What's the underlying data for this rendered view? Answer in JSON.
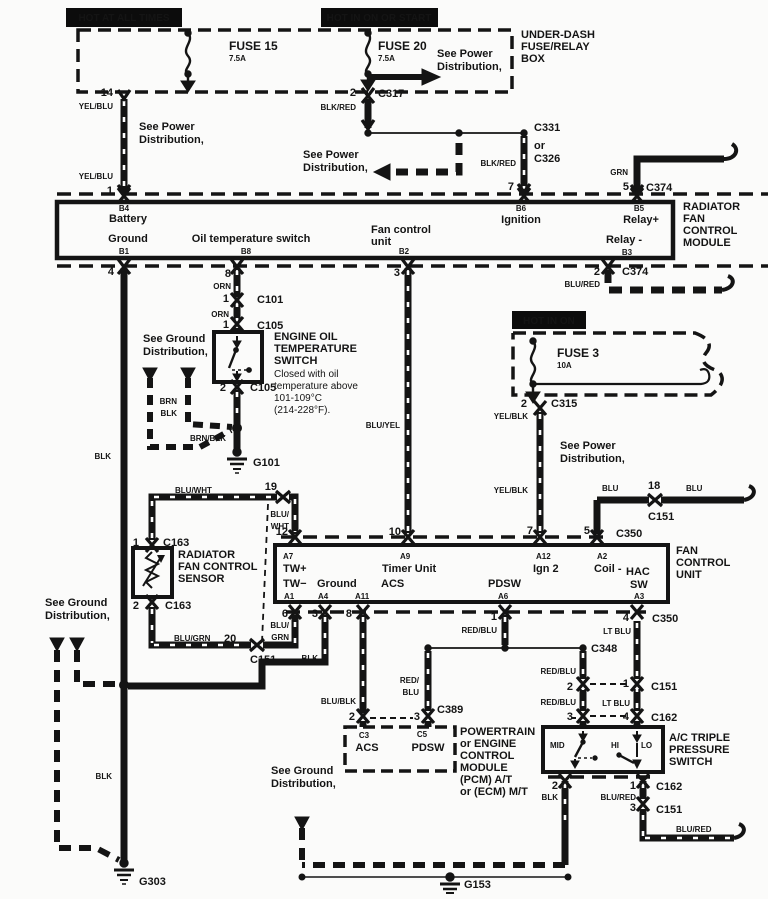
{
  "title": "Radiator fan control wiring diagram",
  "colors": {
    "ink": "#141414",
    "paper": "#fbfbfa",
    "inverse_text": "#ffffff"
  },
  "headers": {
    "hot_at_all_times": "HOT AT ALL TIMES",
    "hot_in_on_or_start": "HOT IN ON OR START",
    "hot_in_on": "HOT IN ON"
  },
  "labels": [
    {
      "n": "hot-at-all-times",
      "t": "HOT AT ALL TIMES",
      "x": 124,
      "y": 21,
      "a": "m",
      "s": 10,
      "c": "#ffffff"
    },
    {
      "n": "hot-in-on-or-start",
      "t": "HOT IN ON OR START",
      "x": 379,
      "y": 21,
      "a": "m",
      "s": 10,
      "c": "#ffffff"
    },
    {
      "n": "fuse15-name",
      "t": "FUSE 15",
      "x": 229,
      "y": 50,
      "s": 12
    },
    {
      "n": "fuse15-amp",
      "t": "7.5A",
      "x": 229,
      "y": 61,
      "s": 8
    },
    {
      "n": "fuse20-name",
      "t": "FUSE 20",
      "x": 378,
      "y": 50,
      "s": 12
    },
    {
      "n": "fuse20-amp",
      "t": "7.5A",
      "x": 378,
      "y": 61,
      "s": 8
    },
    {
      "n": "see-power-1a",
      "t": "See Power",
      "x": 437,
      "y": 57
    },
    {
      "n": "see-power-1b",
      "t": "Distribution,",
      "x": 437,
      "y": 70
    },
    {
      "n": "underdash-1",
      "t": "UNDER-DASH",
      "x": 521,
      "y": 38
    },
    {
      "n": "underdash-2",
      "t": "FUSE/RELAY",
      "x": 521,
      "y": 50
    },
    {
      "n": "underdash-3",
      "t": "BOX",
      "x": 521,
      "y": 62
    },
    {
      "n": "pin-14",
      "t": "14",
      "x": 113,
      "y": 96,
      "a": "e"
    },
    {
      "n": "wire-yelblu-1",
      "t": "YEL/BLU",
      "x": 113,
      "y": 109,
      "a": "e",
      "s": 8
    },
    {
      "n": "see-power-2a",
      "t": "See Power",
      "x": 139,
      "y": 130
    },
    {
      "n": "see-power-2b",
      "t": "Distribution,",
      "x": 139,
      "y": 143
    },
    {
      "n": "wire-yelblu-2",
      "t": "YEL/BLU",
      "x": 113,
      "y": 179,
      "a": "e",
      "s": 8
    },
    {
      "n": "pin-1",
      "t": "1",
      "x": 113,
      "y": 194,
      "a": "e"
    },
    {
      "n": "pin-2-c317",
      "t": "2",
      "x": 356,
      "y": 96,
      "a": "e"
    },
    {
      "n": "wire-blkred-1",
      "t": "BLK/RED",
      "x": 356,
      "y": 110,
      "a": "e",
      "s": 8
    },
    {
      "n": "conn-c317",
      "t": "C317",
      "x": 378,
      "y": 97
    },
    {
      "n": "conn-c331",
      "t": "C331",
      "x": 534,
      "y": 131
    },
    {
      "n": "conn-c326-or",
      "t": "or",
      "x": 534,
      "y": 149
    },
    {
      "n": "conn-c326",
      "t": "C326",
      "x": 534,
      "y": 162
    },
    {
      "n": "wire-blkred-2",
      "t": "BLK/RED",
      "x": 516,
      "y": 166,
      "a": "e",
      "s": 8
    },
    {
      "n": "see-power-3a",
      "t": "See Power",
      "x": 303,
      "y": 158
    },
    {
      "n": "see-power-3b",
      "t": "Distribution,",
      "x": 303,
      "y": 171
    },
    {
      "n": "wire-grn",
      "t": "GRN",
      "x": 628,
      "y": 175,
      "a": "e",
      "s": 8
    },
    {
      "n": "pin-7-c374",
      "t": "7",
      "x": 514,
      "y": 190,
      "a": "e"
    },
    {
      "n": "pin-5-c374",
      "t": "5",
      "x": 629,
      "y": 190,
      "a": "e"
    },
    {
      "n": "conn-c374-top",
      "t": "C374",
      "x": 646,
      "y": 191
    },
    {
      "n": "module-b4",
      "t": "B4",
      "x": 124,
      "y": 211,
      "a": "m",
      "s": 8
    },
    {
      "n": "module-battery",
      "t": "Battery",
      "x": 128,
      "y": 222,
      "a": "m"
    },
    {
      "n": "module-ground",
      "t": "Ground",
      "x": 128,
      "y": 242,
      "a": "m"
    },
    {
      "n": "module-b1",
      "t": "B1",
      "x": 124,
      "y": 254,
      "a": "m",
      "s": 8
    },
    {
      "n": "module-oil-temp",
      "t": "Oil temperature switch",
      "x": 251,
      "y": 242,
      "a": "m"
    },
    {
      "n": "module-b8",
      "t": "B8",
      "x": 246,
      "y": 254,
      "a": "m",
      "s": 8
    },
    {
      "n": "module-fan-a",
      "t": "Fan control",
      "x": 371,
      "y": 233
    },
    {
      "n": "module-fan-b",
      "t": "unit",
      "x": 371,
      "y": 245
    },
    {
      "n": "module-b2",
      "t": "B2",
      "x": 404,
      "y": 254,
      "a": "m",
      "s": 8
    },
    {
      "n": "module-b6",
      "t": "B6",
      "x": 521,
      "y": 211,
      "a": "m",
      "s": 8
    },
    {
      "n": "module-ignition",
      "t": "Ignition",
      "x": 521,
      "y": 223,
      "a": "m"
    },
    {
      "n": "module-b5",
      "t": "B5",
      "x": 639,
      "y": 211,
      "a": "m",
      "s": 8
    },
    {
      "n": "module-relay-plus",
      "t": "Relay+",
      "x": 641,
      "y": 223,
      "a": "m"
    },
    {
      "n": "module-relay-minus",
      "t": "Relay -",
      "x": 624,
      "y": 243,
      "a": "m"
    },
    {
      "n": "module-b3",
      "t": "B3",
      "x": 627,
      "y": 255,
      "a": "m",
      "s": 8
    },
    {
      "n": "rfcm-1",
      "t": "RADIATOR",
      "x": 683,
      "y": 210
    },
    {
      "n": "rfcm-2",
      "t": "FAN",
      "x": 683,
      "y": 222
    },
    {
      "n": "rfcm-3",
      "t": "CONTROL",
      "x": 683,
      "y": 234
    },
    {
      "n": "rfcm-4",
      "t": "MODULE",
      "x": 683,
      "y": 246
    },
    {
      "n": "pin-4",
      "t": "4",
      "x": 114,
      "y": 275,
      "a": "e"
    },
    {
      "n": "pin-8",
      "t": "8",
      "x": 231,
      "y": 277,
      "a": "e"
    },
    {
      "n": "wire-orn-1",
      "t": "ORN",
      "x": 231,
      "y": 289,
      "a": "e",
      "s": 8
    },
    {
      "n": "pin-3-b2",
      "t": "3",
      "x": 400,
      "y": 276,
      "a": "e"
    },
    {
      "n": "pin-2-c374",
      "t": "2",
      "x": 600,
      "y": 275,
      "a": "e"
    },
    {
      "n": "wire-blured-1",
      "t": "BLU/RED",
      "x": 600,
      "y": 287,
      "a": "e",
      "s": 8
    },
    {
      "n": "conn-c374-bot",
      "t": "C374",
      "x": 622,
      "y": 275
    },
    {
      "n": "pin-1-c101",
      "t": "1",
      "x": 229,
      "y": 302,
      "a": "e"
    },
    {
      "n": "conn-c101",
      "t": "C101",
      "x": 257,
      "y": 303
    },
    {
      "n": "wire-orn-2",
      "t": "ORN",
      "x": 229,
      "y": 317,
      "a": "e",
      "s": 8
    },
    {
      "n": "pin-1-c105",
      "t": "1",
      "x": 229,
      "y": 328,
      "a": "e"
    },
    {
      "n": "conn-c105-top",
      "t": "C105",
      "x": 257,
      "y": 329
    },
    {
      "n": "eots-1",
      "t": "ENGINE OIL",
      "x": 274,
      "y": 340
    },
    {
      "n": "eots-2",
      "t": "TEMPERATURE",
      "x": 274,
      "y": 352
    },
    {
      "n": "eots-3",
      "t": "SWITCH",
      "x": 274,
      "y": 364
    },
    {
      "n": "eots-note-1",
      "t": "Closed with oil",
      "x": 274,
      "y": 377,
      "w": 400,
      "s": 10
    },
    {
      "n": "eots-note-2",
      "t": "temperature above",
      "x": 274,
      "y": 389,
      "w": 400,
      "s": 10
    },
    {
      "n": "eots-note-3",
      "t": "101-109°C",
      "x": 274,
      "y": 401,
      "w": 400,
      "s": 10
    },
    {
      "n": "eots-note-4",
      "t": "(214-228°F).",
      "x": 274,
      "y": 413,
      "w": 400,
      "s": 10
    },
    {
      "n": "pin-2-c105",
      "t": "2",
      "x": 226,
      "y": 391,
      "a": "e"
    },
    {
      "n": "conn-c105-bot",
      "t": "C105",
      "x": 250,
      "y": 391
    },
    {
      "n": "see-ground-1a",
      "t": "See Ground",
      "x": 143,
      "y": 342
    },
    {
      "n": "see-ground-1b",
      "t": "Distribution,",
      "x": 143,
      "y": 355
    },
    {
      "n": "wire-brn",
      "t": "BRN",
      "x": 177,
      "y": 404,
      "a": "e",
      "s": 8
    },
    {
      "n": "wire-blk-1",
      "t": "BLK",
      "x": 177,
      "y": 416,
      "a": "e",
      "s": 8
    },
    {
      "n": "wire-brnblk",
      "t": "BRN/BLK",
      "x": 190,
      "y": 441,
      "s": 8
    },
    {
      "n": "gnd-g101",
      "t": "G101",
      "x": 253,
      "y": 466
    },
    {
      "n": "wire-blk-2",
      "t": "BLK",
      "x": 111,
      "y": 459,
      "a": "e",
      "s": 8
    },
    {
      "n": "wire-bluyel",
      "t": "BLU/YEL",
      "x": 400,
      "y": 428,
      "a": "e",
      "s": 8
    },
    {
      "n": "hot-in-on",
      "t": "HOT IN ON",
      "x": 549,
      "y": 324,
      "a": "m",
      "s": 10,
      "c": "#ffffff"
    },
    {
      "n": "fuse3-name",
      "t": "FUSE 3",
      "x": 557,
      "y": 357,
      "s": 12
    },
    {
      "n": "fuse3-amp",
      "t": "10A",
      "x": 557,
      "y": 368,
      "s": 8
    },
    {
      "n": "pin-2-c315",
      "t": "2",
      "x": 527,
      "y": 407,
      "a": "e"
    },
    {
      "n": "conn-c315",
      "t": "C315",
      "x": 551,
      "y": 407
    },
    {
      "n": "wire-yelblk-1",
      "t": "YEL/BLK",
      "x": 528,
      "y": 419,
      "a": "e",
      "s": 8
    },
    {
      "n": "see-power-4a",
      "t": "See Power",
      "x": 560,
      "y": 449
    },
    {
      "n": "see-power-4b",
      "t": "Distribution,",
      "x": 560,
      "y": 462
    },
    {
      "n": "wire-yelblk-2",
      "t": "YEL/BLK",
      "x": 528,
      "y": 493,
      "a": "e",
      "s": 8
    },
    {
      "n": "wire-blu-1",
      "t": "BLU",
      "x": 602,
      "y": 491,
      "s": 8
    },
    {
      "n": "pin-18",
      "t": "18",
      "x": 648,
      "y": 489
    },
    {
      "n": "conn-c151-18",
      "t": "C151",
      "x": 648,
      "y": 520
    },
    {
      "n": "wire-blu-2",
      "t": "BLU",
      "x": 686,
      "y": 491,
      "s": 8
    },
    {
      "n": "pin-7-c350",
      "t": "7",
      "x": 533,
      "y": 534,
      "a": "e"
    },
    {
      "n": "pin-5-c350",
      "t": "5",
      "x": 590,
      "y": 534,
      "a": "e"
    },
    {
      "n": "conn-c350-top",
      "t": "C350",
      "x": 616,
      "y": 537
    },
    {
      "n": "pin-12",
      "t": "12",
      "x": 288,
      "y": 535,
      "a": "e"
    },
    {
      "n": "pin-10",
      "t": "10",
      "x": 401,
      "y": 535,
      "a": "e"
    },
    {
      "n": "pin-19",
      "t": "19",
      "x": 277,
      "y": 490,
      "a": "e"
    },
    {
      "n": "wire-bluwht-1",
      "t": "BLU/WHT",
      "x": 175,
      "y": 493,
      "s": 8
    },
    {
      "n": "wire-bluwht-2a",
      "t": "BLU/",
      "x": 289,
      "y": 517,
      "a": "e",
      "s": 8
    },
    {
      "n": "wire-bluwht-2b",
      "t": "WHT",
      "x": 289,
      "y": 529,
      "a": "e",
      "s": 8
    },
    {
      "n": "fcu-a7",
      "t": "A7",
      "x": 283,
      "y": 559,
      "s": 8
    },
    {
      "n": "fcu-twplus",
      "t": "TW+",
      "x": 283,
      "y": 572
    },
    {
      "n": "fcu-a9",
      "t": "A9",
      "x": 400,
      "y": 559,
      "s": 8
    },
    {
      "n": "fcu-timer-unit",
      "t": "Timer Unit",
      "x": 382,
      "y": 572
    },
    {
      "n": "fcu-a12",
      "t": "A12",
      "x": 536,
      "y": 559,
      "s": 8
    },
    {
      "n": "fcu-ign2",
      "t": "Ign 2",
      "x": 533,
      "y": 572
    },
    {
      "n": "fcu-a2",
      "t": "A2",
      "x": 597,
      "y": 559,
      "s": 8
    },
    {
      "n": "fcu-coil",
      "t": "Coil -",
      "x": 594,
      "y": 572
    },
    {
      "n": "fcu-hac",
      "t": "HAC",
      "x": 626,
      "y": 575
    },
    {
      "n": "fcu-sw",
      "t": "SW",
      "x": 630,
      "y": 588
    },
    {
      "n": "fcu-twminus",
      "t": "TW−",
      "x": 283,
      "y": 587
    },
    {
      "n": "fcu-ground",
      "t": "Ground",
      "x": 317,
      "y": 587
    },
    {
      "n": "fcu-acs",
      "t": "ACS",
      "x": 381,
      "y": 587
    },
    {
      "n": "fcu-pdsw",
      "t": "PDSW",
      "x": 488,
      "y": 587
    },
    {
      "n": "fcu-a1",
      "t": "A1",
      "x": 284,
      "y": 599,
      "s": 8
    },
    {
      "n": "fcu-a4",
      "t": "A4",
      "x": 318,
      "y": 599,
      "s": 8
    },
    {
      "n": "fcu-a11",
      "t": "A11",
      "x": 355,
      "y": 599,
      "s": 8
    },
    {
      "n": "fcu-a6",
      "t": "A6",
      "x": 498,
      "y": 599,
      "s": 8
    },
    {
      "n": "fcu-a3",
      "t": "A3",
      "x": 634,
      "y": 599,
      "s": 8
    },
    {
      "n": "fcu-label-1",
      "t": "FAN",
      "x": 676,
      "y": 554
    },
    {
      "n": "fcu-label-2",
      "t": "CONTROL",
      "x": 676,
      "y": 566
    },
    {
      "n": "fcu-label-3",
      "t": "UNIT",
      "x": 676,
      "y": 578
    },
    {
      "n": "pin-1-c163",
      "t": "1",
      "x": 139,
      "y": 546,
      "a": "e"
    },
    {
      "n": "conn-c163-top",
      "t": "C163",
      "x": 163,
      "y": 546
    },
    {
      "n": "rfcs-1",
      "t": "RADIATOR",
      "x": 178,
      "y": 558
    },
    {
      "n": "rfcs-2",
      "t": "FAN CONTROL",
      "x": 178,
      "y": 570
    },
    {
      "n": "rfcs-3",
      "t": "SENSOR",
      "x": 178,
      "y": 582
    },
    {
      "n": "pin-2-c163",
      "t": "2",
      "x": 139,
      "y": 609,
      "a": "e"
    },
    {
      "n": "conn-c163-bot",
      "t": "C163",
      "x": 165,
      "y": 609
    },
    {
      "n": "see-ground-2a",
      "t": "See Ground",
      "x": 45,
      "y": 606
    },
    {
      "n": "see-ground-2b",
      "t": "Distribution,",
      "x": 45,
      "y": 619
    },
    {
      "n": "wire-blugrn-1",
      "t": "BLU/GRN",
      "x": 174,
      "y": 641,
      "s": 8
    },
    {
      "n": "pin-20",
      "t": "20",
      "x": 224,
      "y": 642
    },
    {
      "n": "conn-c151-sensor",
      "t": "C151",
      "x": 250,
      "y": 663
    },
    {
      "n": "pin-6",
      "t": "6",
      "x": 288,
      "y": 617,
      "a": "e"
    },
    {
      "n": "wire-blugrn-2a",
      "t": "BLU/",
      "x": 289,
      "y": 628,
      "a": "e",
      "s": 8
    },
    {
      "n": "wire-blugrn-2b",
      "t": "GRN",
      "x": 289,
      "y": 640,
      "a": "e",
      "s": 8
    },
    {
      "n": "pin-3-a4",
      "t": "3",
      "x": 318,
      "y": 617,
      "a": "e"
    },
    {
      "n": "pin-8-a11",
      "t": "8",
      "x": 352,
      "y": 617,
      "a": "e"
    },
    {
      "n": "wire-blk-3",
      "t": "BLK",
      "x": 318,
      "y": 661,
      "a": "e",
      "s": 8
    },
    {
      "n": "wire-blublk",
      "t": "BLU/BLK",
      "x": 356,
      "y": 704,
      "a": "e",
      "s": 8
    },
    {
      "n": "pin-2-c389",
      "t": "2",
      "x": 355,
      "y": 720,
      "a": "e"
    },
    {
      "n": "pin-3-c389",
      "t": "3",
      "x": 420,
      "y": 720,
      "a": "e"
    },
    {
      "n": "conn-c389",
      "t": "C389",
      "x": 437,
      "y": 713
    },
    {
      "n": "wire-redblu-pcm-a",
      "t": "RED/",
      "x": 419,
      "y": 683,
      "a": "e",
      "s": 8
    },
    {
      "n": "wire-redblu-pcm-b",
      "t": "BLU",
      "x": 419,
      "y": 695,
      "a": "e",
      "s": 8
    },
    {
      "n": "pin-1-a6",
      "t": "1",
      "x": 497,
      "y": 620,
      "a": "e"
    },
    {
      "n": "wire-redblu-1",
      "t": "RED/BLU",
      "x": 497,
      "y": 633,
      "a": "e",
      "s": 8
    },
    {
      "n": "conn-c348",
      "t": "C348",
      "x": 591,
      "y": 652
    },
    {
      "n": "wire-redblu-2",
      "t": "RED/BLU",
      "x": 576,
      "y": 674,
      "a": "e",
      "s": 8
    },
    {
      "n": "pin-2-c151",
      "t": "2",
      "x": 573,
      "y": 690,
      "a": "e"
    },
    {
      "n": "pin-1-c151",
      "t": "1",
      "x": 629,
      "y": 687,
      "a": "e"
    },
    {
      "n": "conn-c151-mid",
      "t": "C151",
      "x": 651,
      "y": 690
    },
    {
      "n": "wire-redblu-3",
      "t": "RED/BLU",
      "x": 576,
      "y": 705,
      "a": "e",
      "s": 8
    },
    {
      "n": "wire-ltblu-1",
      "t": "LT BLU",
      "x": 630,
      "y": 706,
      "a": "e",
      "s": 8
    },
    {
      "n": "pin-3-c162",
      "t": "3",
      "x": 573,
      "y": 720,
      "a": "e"
    },
    {
      "n": "pin-4-c162",
      "t": "4",
      "x": 629,
      "y": 720,
      "a": "e"
    },
    {
      "n": "conn-c162-top",
      "t": "C162",
      "x": 651,
      "y": 721
    },
    {
      "n": "pin-4-a3",
      "t": "4",
      "x": 629,
      "y": 621,
      "a": "e"
    },
    {
      "n": "wire-ltblu-2",
      "t": "LT BLU",
      "x": 631,
      "y": 634,
      "a": "e",
      "s": 8
    },
    {
      "n": "conn-c350-bot",
      "t": "C350",
      "x": 652,
      "y": 622
    },
    {
      "n": "pcm-c3",
      "t": "C3",
      "x": 364,
      "y": 738,
      "a": "m",
      "s": 8
    },
    {
      "n": "pcm-acs",
      "t": "ACS",
      "x": 367,
      "y": 751,
      "a": "m"
    },
    {
      "n": "pcm-c5",
      "t": "C5",
      "x": 422,
      "y": 737,
      "a": "m",
      "s": 8
    },
    {
      "n": "pcm-pdsw",
      "t": "PDSW",
      "x": 428,
      "y": 751,
      "a": "m"
    },
    {
      "n": "pcm-1",
      "t": "POWERTRAIN",
      "x": 460,
      "y": 735
    },
    {
      "n": "pcm-2",
      "t": "or ENGINE",
      "x": 460,
      "y": 747
    },
    {
      "n": "pcm-3",
      "t": "CONTROL",
      "x": 460,
      "y": 759
    },
    {
      "n": "pcm-4",
      "t": "MODULE",
      "x": 460,
      "y": 771
    },
    {
      "n": "pcm-5",
      "t": "(PCM) A/T",
      "x": 460,
      "y": 783
    },
    {
      "n": "pcm-6",
      "t": "or (ECM) M/T",
      "x": 460,
      "y": 795
    },
    {
      "n": "acts-mid",
      "t": "MID",
      "x": 550,
      "y": 748,
      "s": 8
    },
    {
      "n": "acts-hi",
      "t": "HI",
      "x": 611,
      "y": 748,
      "s": 8
    },
    {
      "n": "acts-lo",
      "t": "LO",
      "x": 641,
      "y": 748,
      "s": 8
    },
    {
      "n": "acts-1",
      "t": "A/C TRIPLE",
      "x": 669,
      "y": 741
    },
    {
      "n": "acts-2",
      "t": "PRESSURE",
      "x": 669,
      "y": 753
    },
    {
      "n": "acts-3",
      "t": "SWITCH",
      "x": 669,
      "y": 765
    },
    {
      "n": "pin-2-acts",
      "t": "2",
      "x": 558,
      "y": 789,
      "a": "e"
    },
    {
      "n": "wire-blk-4",
      "t": "BLK",
      "x": 558,
      "y": 800,
      "a": "e",
      "s": 8
    },
    {
      "n": "pin-1-acts",
      "t": "1",
      "x": 636,
      "y": 789,
      "a": "e"
    },
    {
      "n": "wire-blured-2",
      "t": "BLU/RED",
      "x": 636,
      "y": 800,
      "a": "e",
      "s": 8
    },
    {
      "n": "conn-c162-bot",
      "t": "C162",
      "x": 656,
      "y": 790
    },
    {
      "n": "pin-3-c151",
      "t": "3",
      "x": 636,
      "y": 811,
      "a": "e"
    },
    {
      "n": "conn-c151-bot",
      "t": "C151",
      "x": 656,
      "y": 813
    },
    {
      "n": "wire-blured-3",
      "t": "BLU/RED",
      "x": 676,
      "y": 832,
      "s": 8
    },
    {
      "n": "see-ground-3a",
      "t": "See Ground",
      "x": 271,
      "y": 774
    },
    {
      "n": "see-ground-3b",
      "t": "Distribution,",
      "x": 271,
      "y": 787
    },
    {
      "n": "gnd-g153",
      "t": "G153",
      "x": 464,
      "y": 888
    },
    {
      "n": "wire-blk-5",
      "t": "BLK",
      "x": 112,
      "y": 779,
      "a": "e",
      "s": 8
    },
    {
      "n": "gnd-g303",
      "t": "G303",
      "x": 139,
      "y": 885
    }
  ]
}
